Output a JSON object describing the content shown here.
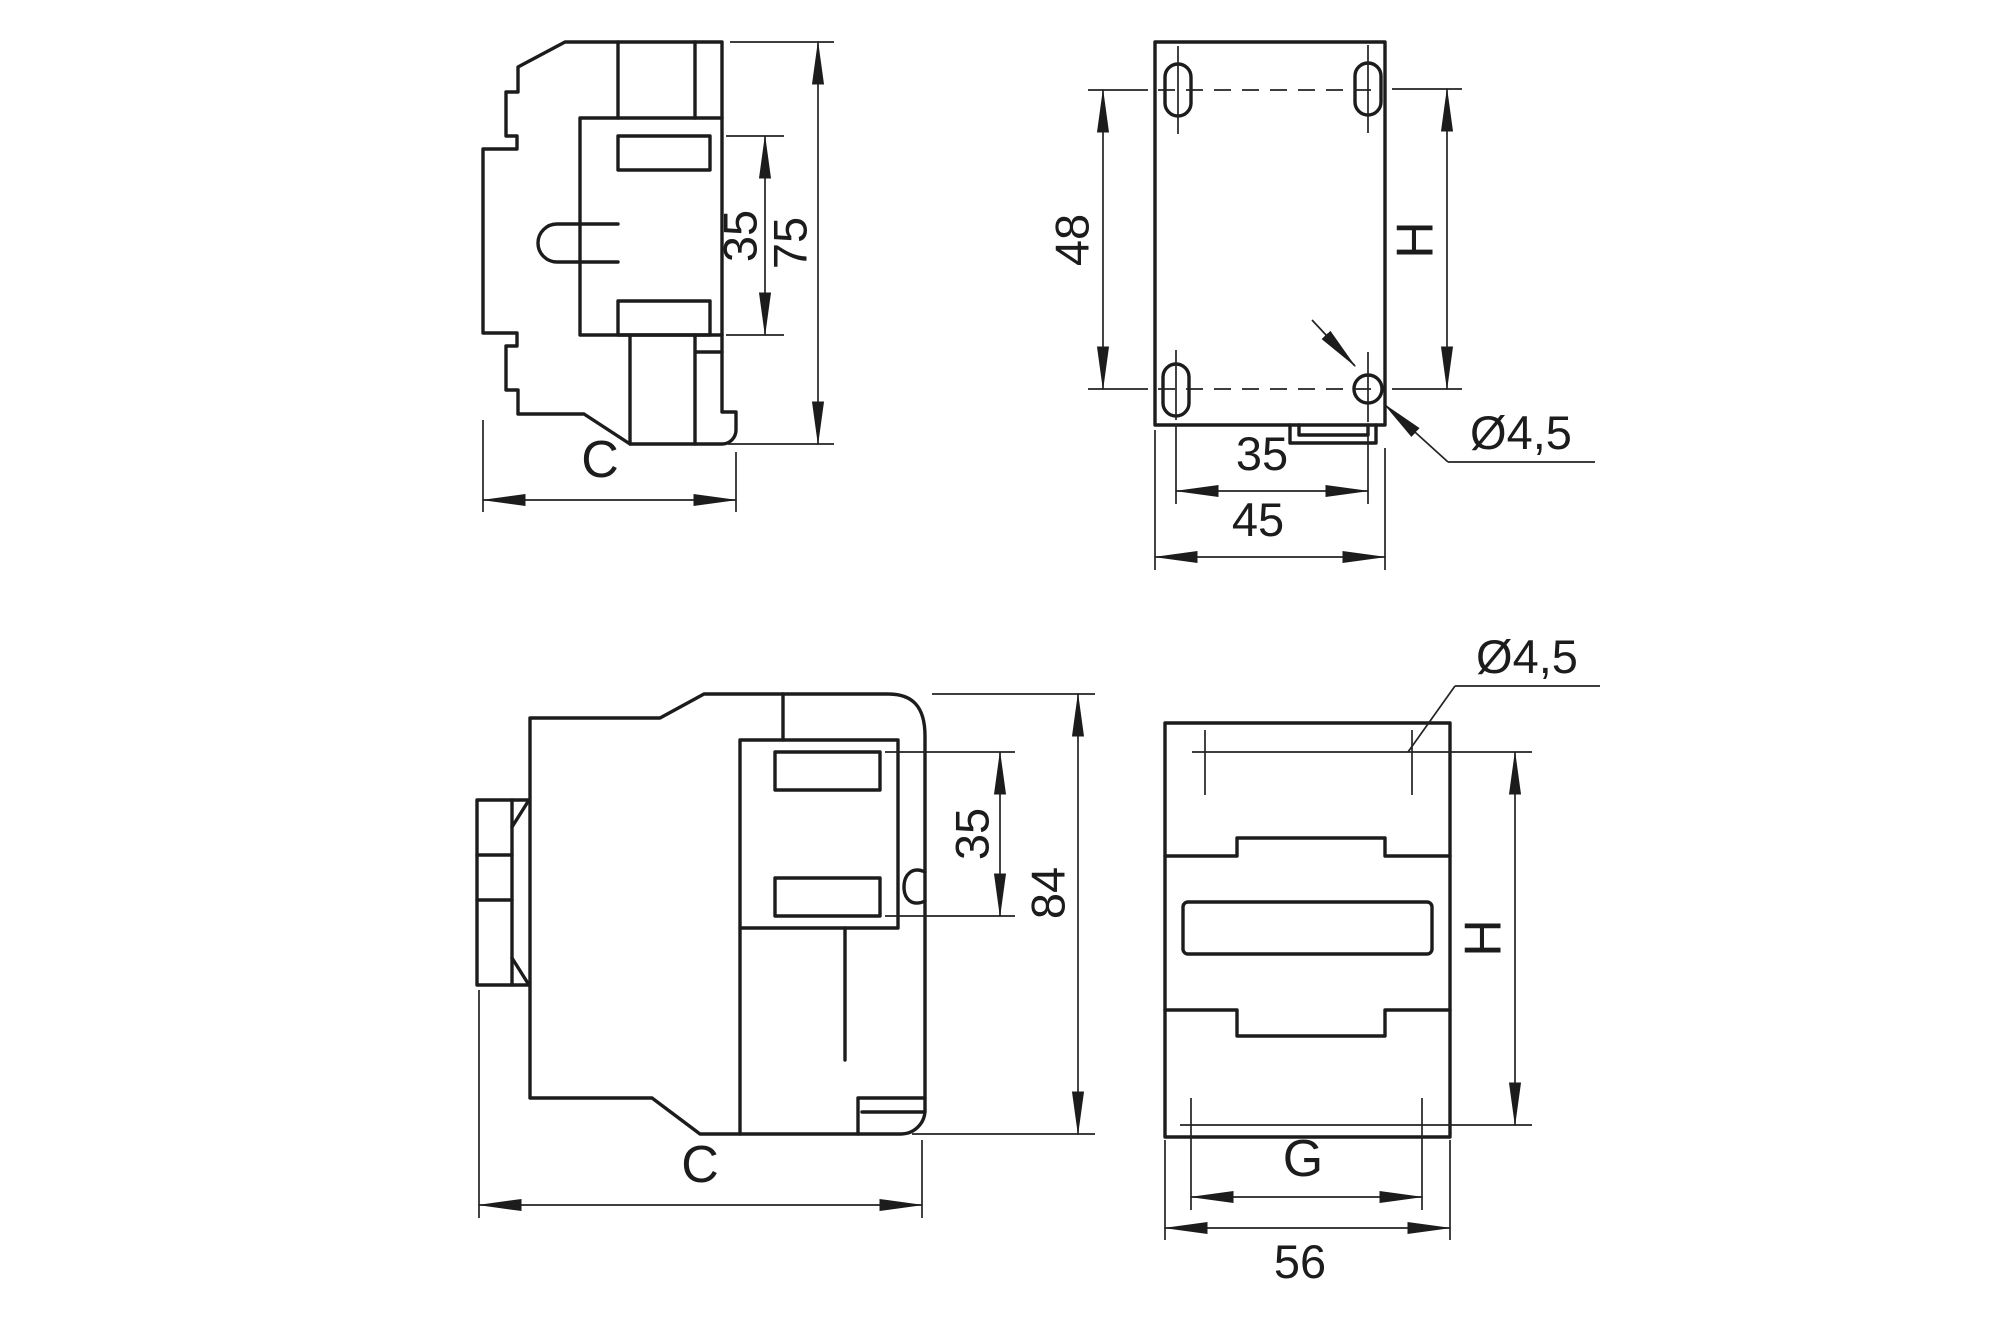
{
  "figure": {
    "type": "engineering-dimensional-drawing",
    "subject": "contactor outline with mounting dimensions",
    "background_color": "#ffffff",
    "line_color": "#1c1c1c"
  },
  "views": {
    "side_top": {
      "label": "upper side view",
      "dims": {
        "rail_height": "35",
        "overall_height": "75",
        "depth": "C"
      }
    },
    "back": {
      "label": "upper mounting-hole view",
      "dims": {
        "vertical_hole_spacing": "48",
        "mounting_height": "H",
        "horizontal_hole_spacing": "35",
        "overall_width": "45",
        "hole_diameter": "Ø4,5"
      }
    },
    "side_bottom": {
      "label": "lower side view",
      "dims": {
        "rail_height": "35",
        "overall_height": "84",
        "depth": "C"
      }
    },
    "front": {
      "label": "lower front view",
      "dims": {
        "hole_diameter": "Ø4,5",
        "mounting_height": "H",
        "inner_width": "G",
        "overall_width": "56"
      }
    }
  }
}
